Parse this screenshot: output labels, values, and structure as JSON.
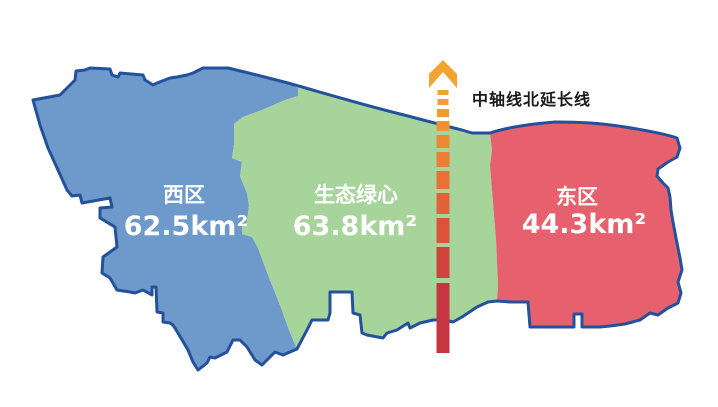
{
  "title": "城市三区规划示意图",
  "colors": {
    "west": "#6E99CB",
    "green_heart": "#A7D49B",
    "east": "#E6616D",
    "outline": "#24519B",
    "axis_arrow": "#F2A430",
    "axis_red_end": "#C63641",
    "label_text": "#FFFFFF",
    "axis_label_text": "#1A1A1A",
    "background": "#FFFFFF"
  },
  "regions": [
    {
      "id": "west",
      "name": "西区",
      "area": "62.5km²"
    },
    {
      "id": "green-heart",
      "name": "生态绿心",
      "area": "63.8km²"
    },
    {
      "id": "east",
      "name": "东区",
      "area": "44.3km²"
    }
  ],
  "axis": {
    "label": "中轴线北延长线",
    "center_x": 443,
    "dashes": [
      {
        "y": 90,
        "h": 5,
        "w": 11,
        "color": "#F4A52E"
      },
      {
        "y": 99,
        "h": 6,
        "w": 11,
        "color": "#F3A030"
      },
      {
        "y": 109,
        "h": 8,
        "w": 12,
        "color": "#F29A31"
      },
      {
        "y": 121,
        "h": 10,
        "w": 13,
        "color": "#F09232"
      },
      {
        "y": 135,
        "h": 13,
        "w": 13,
        "color": "#EE8933"
      },
      {
        "y": 152,
        "h": 15,
        "w": 13,
        "color": "#EB7E34"
      },
      {
        "y": 171,
        "h": 18,
        "w": 13,
        "color": "#E87136"
      },
      {
        "y": 193,
        "h": 21,
        "w": 13,
        "color": "#E36338"
      },
      {
        "y": 218,
        "h": 25,
        "w": 13,
        "color": "#DC523A"
      },
      {
        "y": 247,
        "h": 31,
        "w": 13,
        "color": "#D2423D"
      },
      {
        "y": 283,
        "h": 70,
        "w": 13,
        "color": "#C63641"
      }
    ]
  }
}
